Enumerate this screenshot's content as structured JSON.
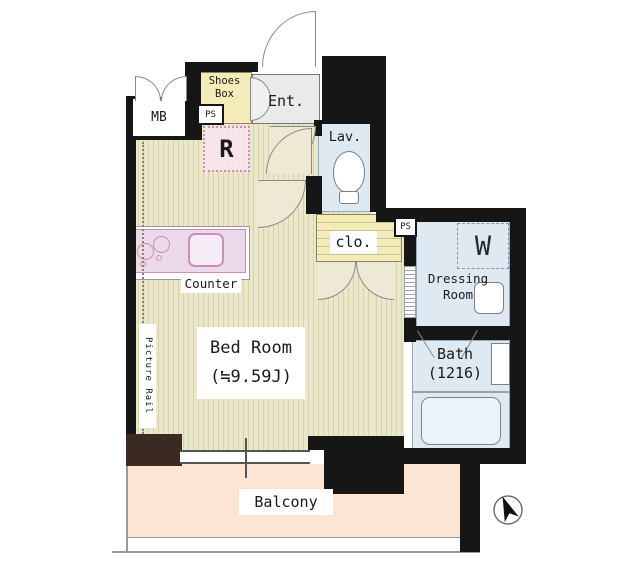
{
  "plan_type": "floor-plan",
  "colors": {
    "wall": "#161616",
    "brown": "#3a2a22",
    "floor": "#ebe7cb",
    "stripe": "#d7d1ac",
    "balcony": "#fce5d2",
    "water": "#dfe9f1",
    "tub": "#eaf3f8",
    "yellow": "#f4ecb8",
    "pink": "#f8e4ee",
    "pinkline": "#cf8fb4",
    "counter": "#ecdaeb",
    "gray": "#eaeaea",
    "line": "#8a8a8a",
    "text": "#1a1a1a"
  },
  "labels": {
    "meter_box": "MB",
    "pipe_space_1": "PS",
    "pipe_space_2": "PS",
    "shoes_box_line1": "Shoes",
    "shoes_box_line2": "Box",
    "refrigerator": "R",
    "entrance": "Ent.",
    "lavatory": "Lav.",
    "closet": "clo.",
    "dressing_line1": "Dressing",
    "dressing_line2": "Room",
    "washer": "W",
    "bath_line1": "Bath",
    "bath_line2": "(1216)",
    "bedroom_line1": "Bed Room",
    "bedroom_line2": "(≒9.59J)",
    "counter": "Counter",
    "picture_rail": "Picture Rail",
    "balcony": "Balcony"
  },
  "icons": {
    "compass": "north-arrow"
  }
}
